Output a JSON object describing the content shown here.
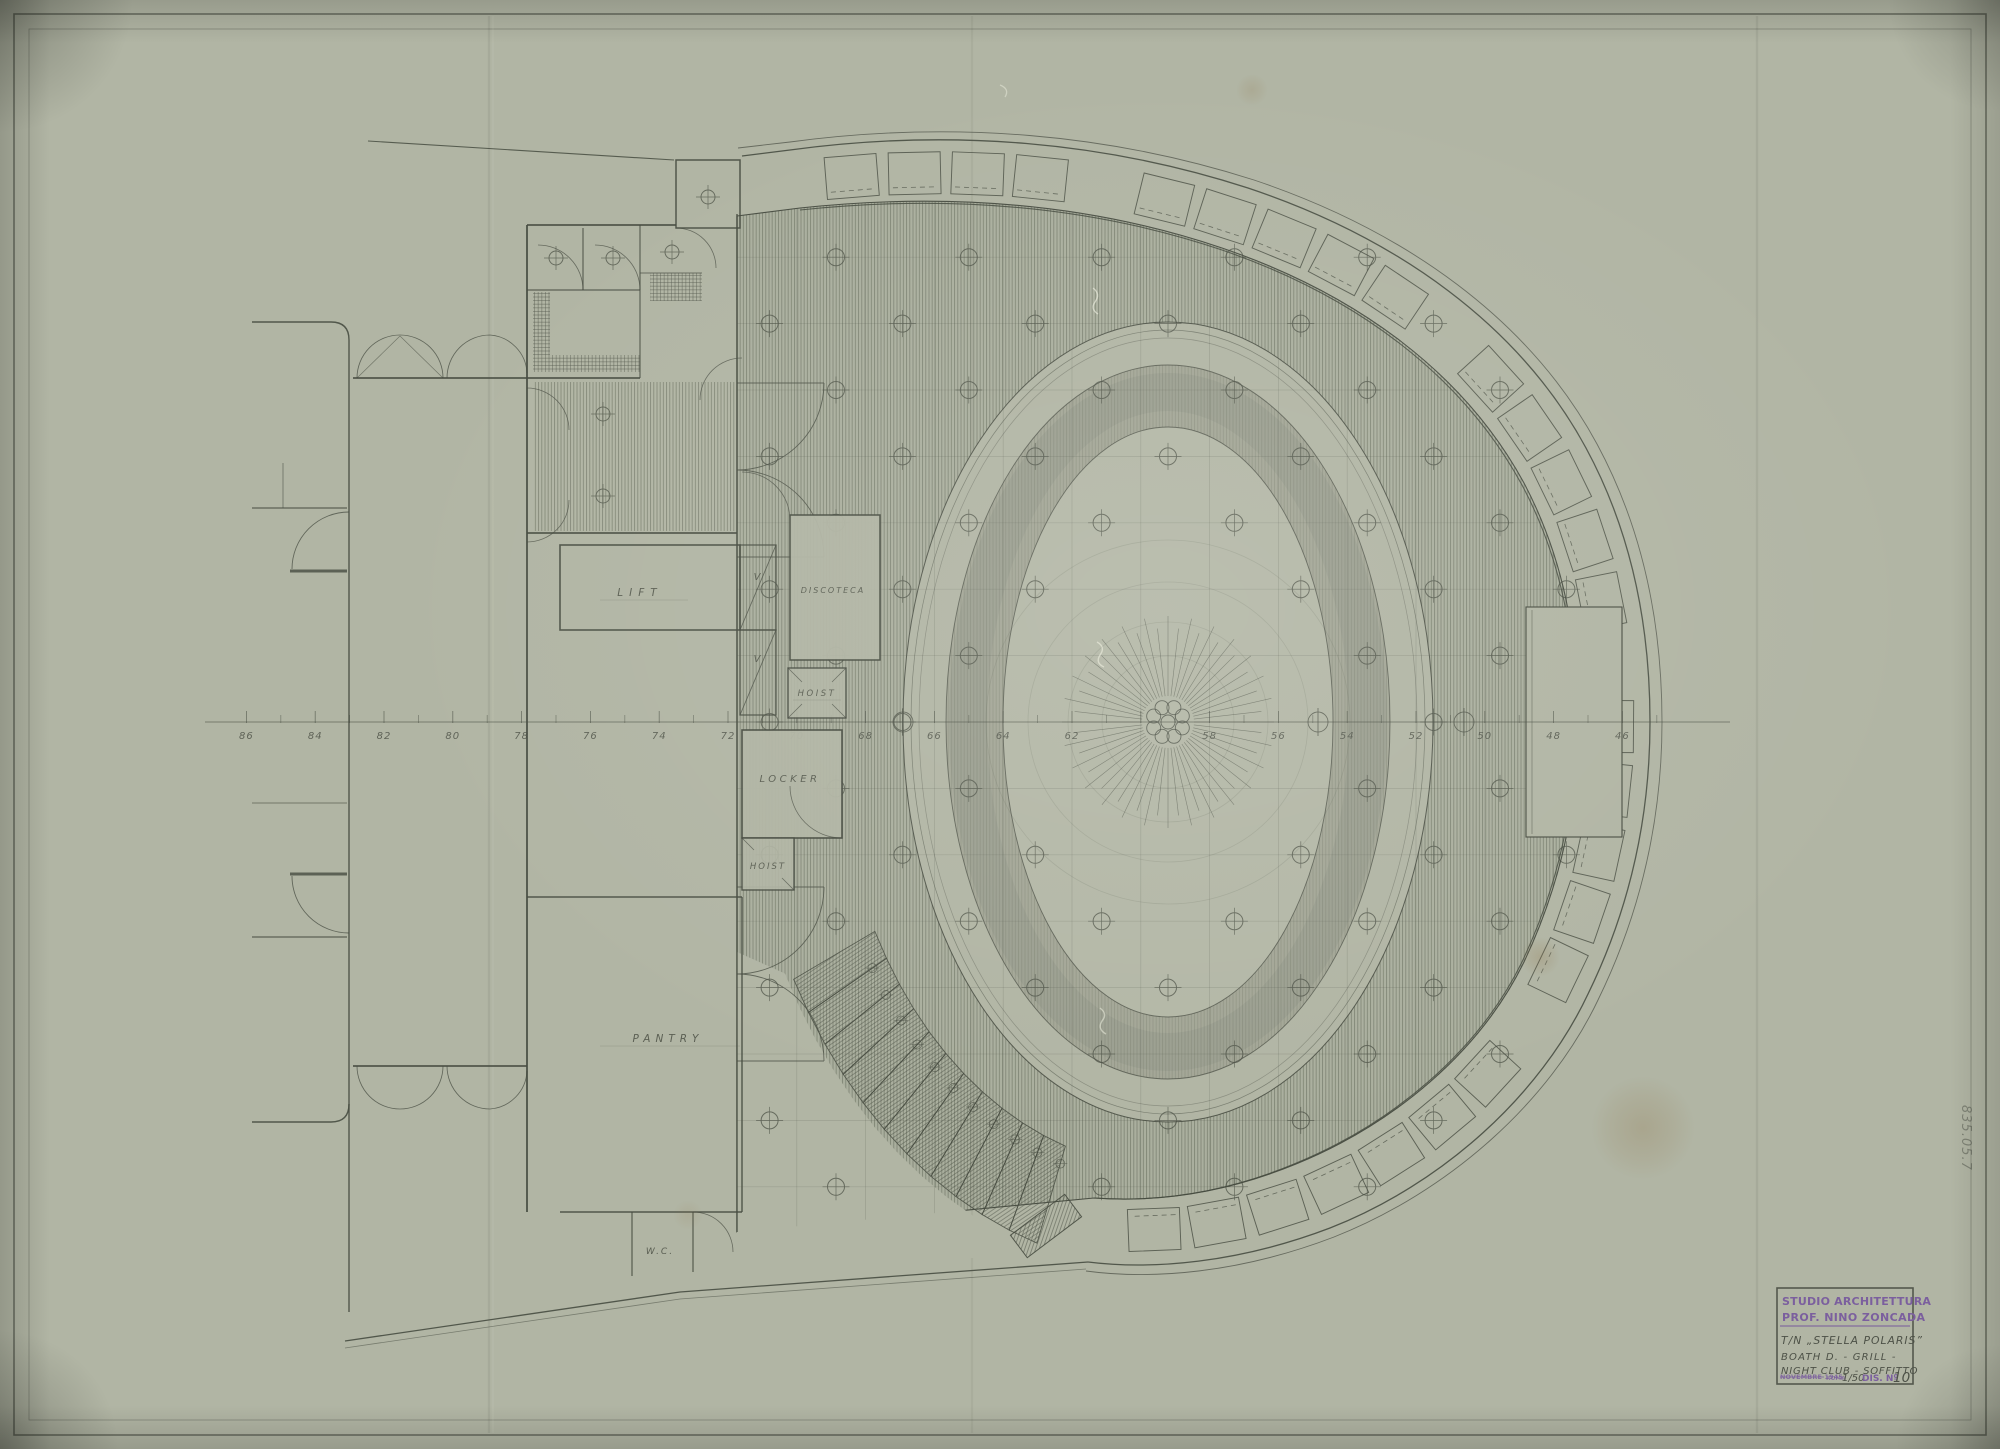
{
  "sheet": {
    "centerline_frames": [
      "86",
      "84",
      "82",
      "80",
      "78",
      "76",
      "74",
      "72",
      "70",
      "68",
      "66",
      "64",
      "62",
      "58",
      "56",
      "54",
      "52",
      "50",
      "48",
      "46"
    ],
    "archive_number": "835.05.7"
  },
  "rooms": {
    "lift": "LIFT",
    "discoteca": "DISCOTECA",
    "hoist_upper": "HOIST",
    "locker": "LOCKER",
    "hoist_lower": "HOIST",
    "pantry": "PANTRY",
    "wc": "W.C.",
    "vent_1": "V",
    "vent_2": "V"
  },
  "title_block": {
    "studio_line1": "STUDIO ARCHITETTURA",
    "studio_line2": "PROF. NINO ZONCADA",
    "vessel": "T/N „STELLA POLARIS”",
    "subject_line1": "BOATH D. - GRILL -",
    "subject_line2": "NIGHT CLUB - SOFFITTO",
    "date_stamp": "NOVEMBRE 1945",
    "place_stamp": "ROMA",
    "scale": "1/50",
    "dis_label": "DIS. Nº",
    "drawing_number": "10"
  },
  "colors": {
    "paper": "#b1b5a4",
    "ink": "#474c41",
    "stamp_purple": "#7b5f9e",
    "pencil": "#4d5147"
  }
}
